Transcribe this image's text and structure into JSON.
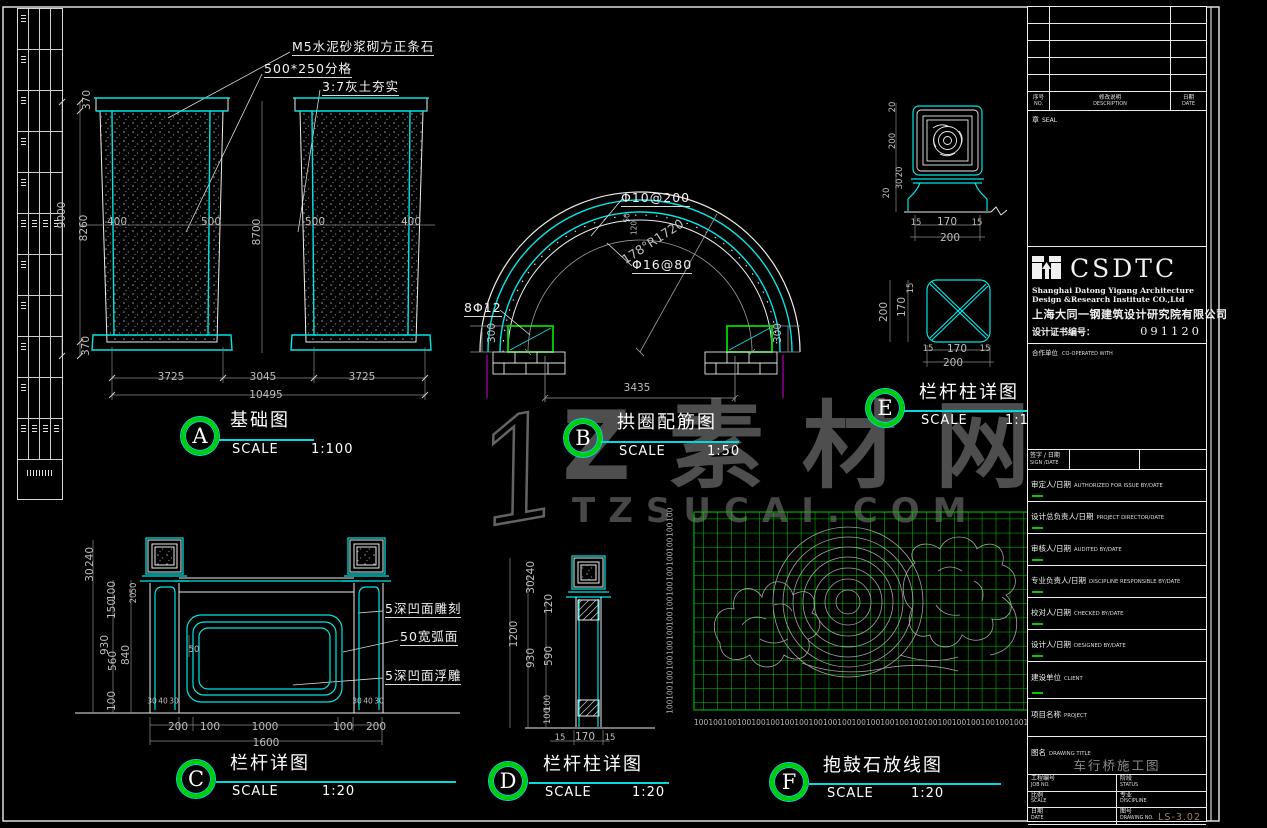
{
  "watermark": {
    "numeral": "1",
    "brand": "Z素材网",
    "domain": "TZSUCAI.COM"
  },
  "captions": {
    "a": {
      "letter": "A",
      "title": "基础图",
      "scale_label": "SCALE",
      "scale": "1:100"
    },
    "b": {
      "letter": "B",
      "title": "拱圈配筋图",
      "scale_label": "SCALE",
      "scale": "1:50"
    },
    "c": {
      "letter": "C",
      "title": "栏杆详图",
      "scale_label": "SCALE",
      "scale": "1:20"
    },
    "d": {
      "letter": "D",
      "title": "栏杆柱详图",
      "scale_label": "SCALE",
      "scale": "1:20"
    },
    "e": {
      "letter": "E",
      "title": "栏杆柱详图",
      "scale_label": "SCALE",
      "scale": "1:10"
    },
    "f": {
      "letter": "F",
      "title": "抱鼓石放线图",
      "scale_label": "SCALE",
      "scale": "1:20"
    }
  },
  "foundation": {
    "notes": [
      "M5水泥砂浆砌方正条石",
      "500*250分格",
      "3:7灰土夯实"
    ],
    "left_dims": {
      "total": "9000",
      "top": "370",
      "middle": "8260",
      "bottom": "370"
    },
    "mid_dims": [
      "400",
      "500",
      "8700",
      "500",
      "400"
    ],
    "bottom_dims": [
      "3725",
      "3045",
      "3725"
    ],
    "bottom_total": "10495"
  },
  "arch": {
    "rebar_top": "Φ10@200",
    "radius": "178°R1720",
    "rebar_arc": "Φ16@80",
    "rebar_side": "8Φ12",
    "crown_dims": [
      "50",
      "120"
    ],
    "side_dim": "300",
    "span": "3435"
  },
  "railing": {
    "notes": [
      "5深凹面雕刻",
      "50宽弧面",
      "5深凹面浮雕"
    ],
    "left_c1": [
      "240",
      "30",
      "930"
    ],
    "left_c2": [
      "100",
      "150",
      "560",
      "100"
    ],
    "left_c3": [
      "50",
      "20",
      "840"
    ],
    "mid_dim": "50",
    "base_dims": [
      "30",
      "40",
      "30"
    ],
    "bottom_dims": [
      "200",
      "100",
      "1000",
      "100",
      "200"
    ],
    "bottom_total": "1600"
  },
  "post_d": {
    "total": "1200",
    "c2": [
      "240",
      "30",
      "930"
    ],
    "c3": [
      "120",
      "590"
    ],
    "c4": [
      "100",
      "100"
    ],
    "bottom_dims": [
      "15",
      "170",
      "15"
    ]
  },
  "post_e": {
    "elev_dims": [
      "20",
      "200",
      "20",
      "30",
      "20"
    ],
    "elev_bottom": [
      "15",
      "170",
      "15"
    ],
    "elev_total": "200",
    "plan_left": [
      "15",
      "170",
      "200"
    ],
    "plan_bottom": [
      "15",
      "170",
      "15"
    ],
    "plan_total": "200"
  },
  "layout_grid": {
    "unit": "100"
  },
  "titleblock": {
    "rev_header": {
      "no_cn": "序号",
      "no_en": "NO.",
      "desc_cn": "修改说明",
      "desc_en": "DESCRIPTION",
      "date_cn": "日期",
      "date_en": "DATE"
    },
    "seal": {
      "cn": "章",
      "en": "SEAL"
    },
    "logo": {
      "acronym": "CSDTC",
      "en_line1": "Shanghai Datong Yigang  Architecture",
      "en_line2": "Design &Research Institute CO.,Ltd",
      "cn_name": "上海大同一钢建筑设计研究院有限公司",
      "cert_label": "设计证书编号：",
      "cert_no": "091120"
    },
    "coop": {
      "cn": "合作单位",
      "en": "CO-OPERATED WITH"
    },
    "sign_date": {
      "cn": "签字 / 日期",
      "en": "SIGN /DATE"
    },
    "sign_rows": [
      {
        "cn": "审定人/日期",
        "en": "AUTHORIZED FOR ISSUE BY/DATE"
      },
      {
        "cn": "设计总负责人/日期",
        "en": "PROJECT DIRECTOR/DATE"
      },
      {
        "cn": "审核人/日期",
        "en": "AUDITED BY/DATE"
      },
      {
        "cn": "专业负责人/日期",
        "en": "DISCIPLINE RESPONSIBLE BY/DATE"
      },
      {
        "cn": "校对人/日期",
        "en": "CHECKED BY/DATE"
      },
      {
        "cn": "设计人/日期",
        "en": "DESIGNED BY/DATE"
      }
    ],
    "client": {
      "cn": "建设单位",
      "en": "CLIENT"
    },
    "project": {
      "cn": "项目名称",
      "en": "PROJECT"
    },
    "drawing": {
      "cn": "图名",
      "en": "DRAWING TITLE",
      "value": "车行桥施工图"
    },
    "job": {
      "cn": "工程编号",
      "en": "JOB NO."
    },
    "status": {
      "cn": "阶段",
      "en": "STATUS"
    },
    "scale": {
      "cn": "比例",
      "en": "SCALE"
    },
    "discipline": {
      "cn": "专业",
      "en": "DISCIPLINE"
    },
    "date": {
      "cn": "日期",
      "en": "DATE"
    },
    "dwg_no": {
      "cn": "图号",
      "en": "DRAWING NO.",
      "value": "LS-3.02"
    }
  }
}
